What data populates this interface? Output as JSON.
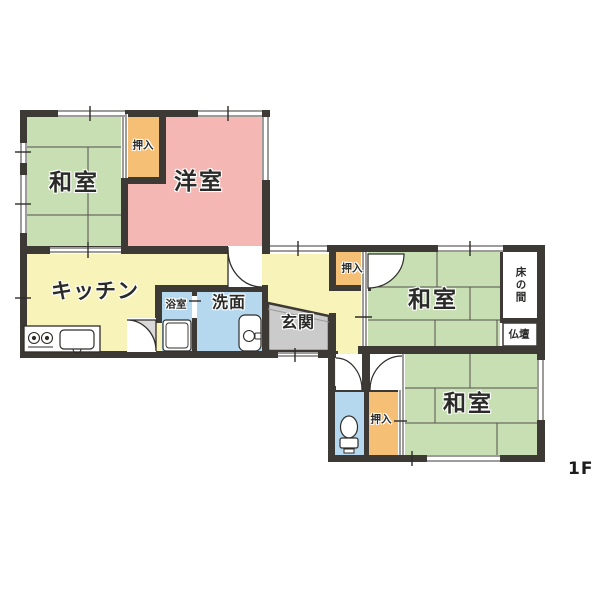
{
  "floor": {
    "label": "1F"
  },
  "colors": {
    "background": "#ffffff",
    "wall": "#3d3a36",
    "tatami_green": "#c8dfb4",
    "western_pink": "#f4b7b4",
    "kitchen_yellow": "#f8f3b9",
    "closet_orange": "#f6bf76",
    "water_blue": "#b5d8ef",
    "entry_gray": "#cbcbcb",
    "door_shade": "#d9d9d9",
    "tatami_line": "#55524c",
    "label_text": "#2a2a28"
  },
  "rooms": {
    "washitsu_nw": {
      "label": "和室"
    },
    "oshiire_nw": {
      "label": "押入"
    },
    "youshitsu": {
      "label": "洋室"
    },
    "kitchen": {
      "label": "キッチン"
    },
    "bathroom": {
      "label": "浴室"
    },
    "washroom": {
      "label": "洗面"
    },
    "genkan": {
      "label": "玄関"
    },
    "oshiire_mid": {
      "label": "押入"
    },
    "washitsu_mid": {
      "label": "和室"
    },
    "tokonoma": {
      "label": "床の間"
    },
    "butsudan": {
      "label": "仏壇"
    },
    "oshiire_s": {
      "label": "押入"
    },
    "washitsu_se": {
      "label": "和室"
    }
  }
}
